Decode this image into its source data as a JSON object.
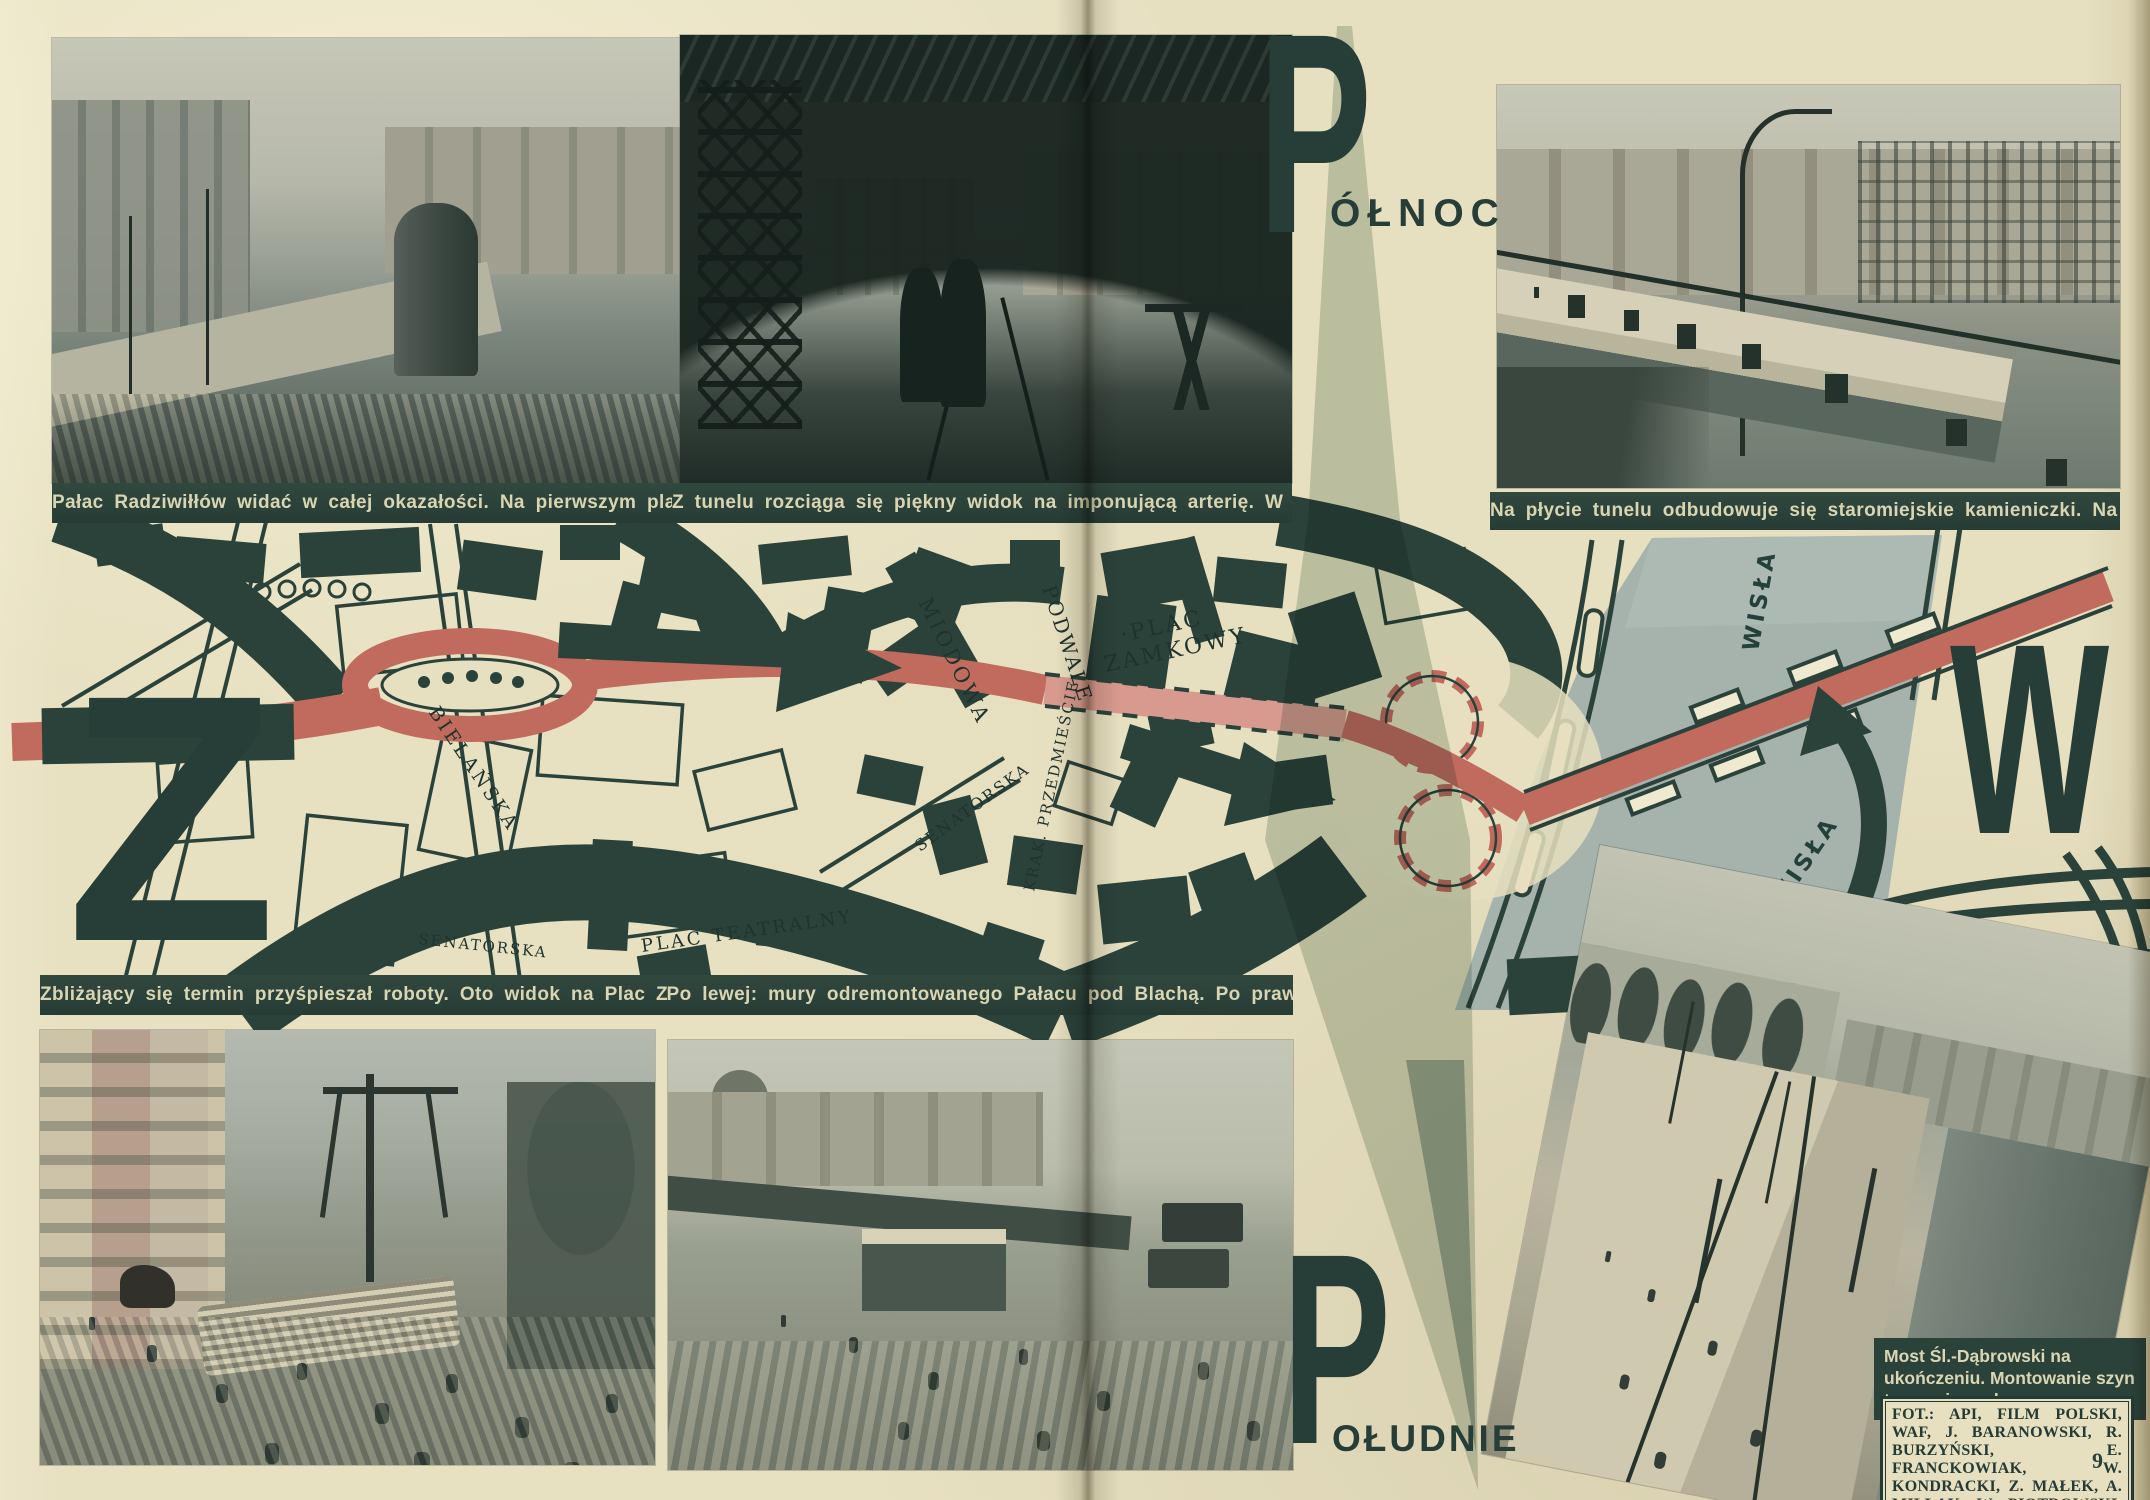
{
  "page": {
    "number": "9"
  },
  "compass": {
    "north_letter": "P",
    "north_word": "ÓŁNOC",
    "south_letter": "P",
    "south_word": "OŁUDNIE",
    "west_letter": "Z",
    "east_letter": "W"
  },
  "captions": {
    "top_left": "Pałac Radziwiłłów widać w całej okazałości. Na pierwszym planie popularna „Gruba Kaśka“",
    "top_middle": "Z tunelu rozciąga się piękny widok na imponującą arterię. W głębi po prawej — Hipoteka",
    "top_right": "Na płycie tunelu odbudowuje się staromiejskie kamieniczki. Na prawo od nich — pałac Sołtyka",
    "middle_left": "Zbliżający się termin przyśpieszał roboty. Oto widok na Plac Zamkowy dnia 5 lipca 1949",
    "middle_right": "Po lewej: mury odremontowanego Pałacu pod Blachą. Po prawej w dalszym planie — Wisła",
    "bottom_right_title": "Most Śl.-Dąbrowski na ukończeniu. Montowanie szyn tramwajowych",
    "credits": "FOT.: API, FILM POLSKI, WAF, J. BARANOWSKI, R. BURZYŃSKI, E. FRANCKOWIAK, W. KONDRACKI, Z. MAŁEK, A. MILLAK, W. PIOTROWSKI, WIESIOŁEK"
  },
  "map": {
    "labels": {
      "miodowa": "MIODOWA",
      "podwale": "PODWALE",
      "plac_zamkowy_1": "·PLAC",
      "plac_zamkowy_2": "ZAMKOWY",
      "bielanska": "BIELAŃSKA",
      "senatorska_w": "SENATORSKA",
      "senatorska_e": "SENATORSKA",
      "plac_teatralny": "PLAC TEATRALNY",
      "krak_przedmiescie": "KRAK. PRZEDMIEŚCIE",
      "wisla_north": "WISŁA",
      "wisla_south": "WISŁA"
    },
    "colors": {
      "route_red": "#c16a5e",
      "route_tunnel_pink": "#d89a8f",
      "road_dark": "#2b423b",
      "river": "#a6b3ad",
      "needle": "#c3cec7",
      "paper": "#e6dfc0"
    }
  }
}
